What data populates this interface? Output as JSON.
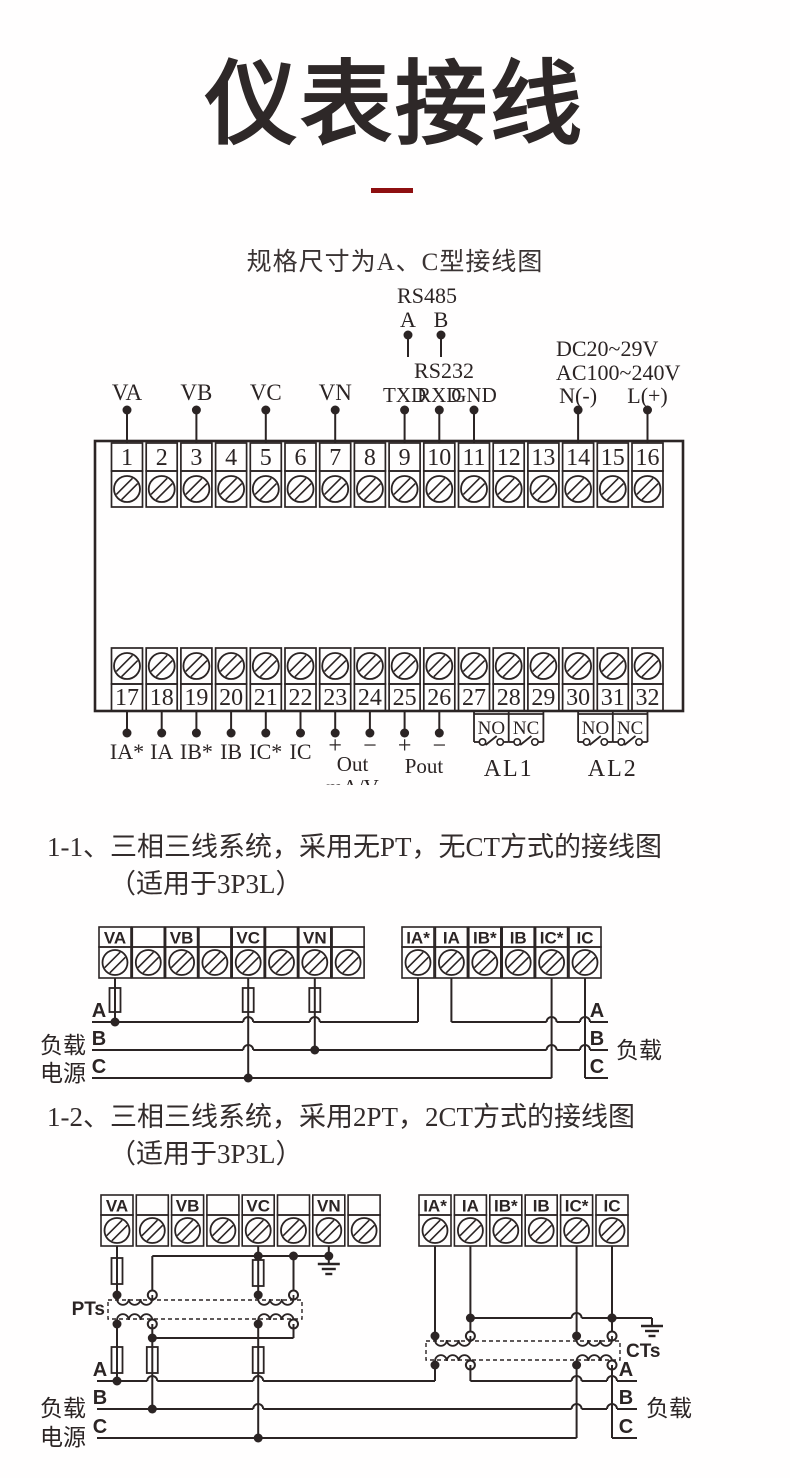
{
  "header": {
    "title": "仪表接线",
    "subtitle": "规格尺寸为A、C型接线图"
  },
  "theme": {
    "ink": "#2b2424",
    "accent_red": "#8e0f10",
    "background": "#ffffff"
  },
  "main_block": {
    "top_terminal_numbers": [
      "1",
      "2",
      "3",
      "4",
      "5",
      "6",
      "7",
      "8",
      "9",
      "10",
      "11",
      "12",
      "13",
      "14",
      "15",
      "16"
    ],
    "bottom_terminal_numbers": [
      "17",
      "18",
      "19",
      "20",
      "21",
      "22",
      "23",
      "24",
      "25",
      "26",
      "27",
      "28",
      "29",
      "30",
      "31",
      "32"
    ],
    "voltage_labels": [
      "VA",
      "VB",
      "VC",
      "VN"
    ],
    "rs485": {
      "title": "RS485",
      "a": "A",
      "b": "B"
    },
    "rs232": {
      "title": "RS232",
      "pins": [
        "TXD",
        "RXD",
        "GND"
      ]
    },
    "power": {
      "dc": "DC20~29V",
      "ac": "AC100~240V",
      "neutral": "N(-)",
      "live": "L(+)"
    },
    "current_labels": [
      "IA*",
      "IA",
      "IB*",
      "IB",
      "IC*",
      "IC"
    ],
    "analog_out": {
      "plus": "+",
      "minus": "−",
      "label": "Out",
      "unit": "mA/V"
    },
    "power_out": {
      "plus": "+",
      "minus": "−",
      "label": "Pout"
    },
    "relays": {
      "no": "NO",
      "nc": "NC",
      "al1": "AL1",
      "al2": "AL2"
    }
  },
  "sections": [
    {
      "line1": "1-1、三相三线系统，采用无PT，无CT方式的接线图",
      "line2": "（适用于3P3L）"
    },
    {
      "line1": "1-2、三相三线系统，采用2PT，2CT方式的接线图",
      "line2": "（适用于3P3L）"
    }
  ],
  "diagram_3p3l_direct": {
    "voltage_terminals": [
      "VA",
      "",
      "VB",
      "",
      "VC",
      "",
      "VN",
      ""
    ],
    "current_terminals": [
      "IA*",
      "IA",
      "IB*",
      "IB",
      "IC*",
      "IC"
    ],
    "phases": [
      "A",
      "B",
      "C"
    ],
    "left_labels": {
      "load": "负载",
      "source": "电源"
    },
    "right_label": "负载"
  },
  "diagram_3p3l_pt_ct": {
    "voltage_terminals": [
      "VA",
      "",
      "VB",
      "",
      "VC",
      "",
      "VN",
      ""
    ],
    "current_terminals": [
      "IA*",
      "IA",
      "IB*",
      "IB",
      "IC*",
      "IC"
    ],
    "phases": [
      "A",
      "B",
      "C"
    ],
    "left_labels": {
      "load": "负载",
      "source": "电源"
    },
    "right_label": "负载",
    "pt_label": "PTs",
    "ct_label": "CTs"
  }
}
